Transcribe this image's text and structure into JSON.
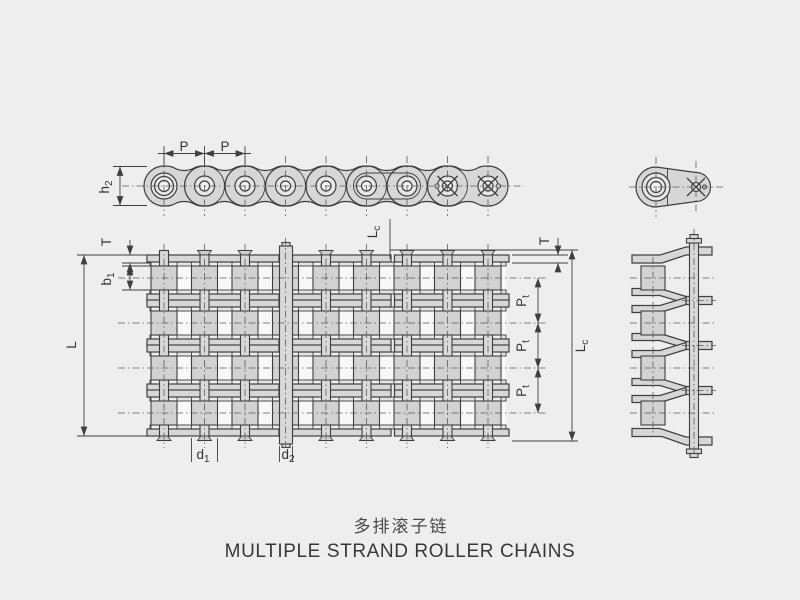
{
  "title": {
    "zh": "多排滚子链",
    "en": "MULTIPLE STRAND ROLLER CHAINS"
  },
  "dims": {
    "p": {
      "main": "P",
      "sub": ""
    },
    "h2": {
      "main": "h",
      "sub": "2"
    },
    "b1": {
      "main": "b",
      "sub": "1"
    },
    "t": {
      "main": "T",
      "sub": ""
    },
    "l": {
      "main": "L",
      "sub": ""
    },
    "lc": {
      "main": "L",
      "sub": "c"
    },
    "pt": {
      "main": "P",
      "sub": "t"
    },
    "d1": {
      "main": "d",
      "sub": "1"
    },
    "d2": {
      "main": "d",
      "sub": "2"
    }
  },
  "colors": {
    "background": "#eeeeee",
    "line": "#3f3f3f",
    "fill": "#d7d7d7",
    "centerline": "#5a5a5a"
  }
}
